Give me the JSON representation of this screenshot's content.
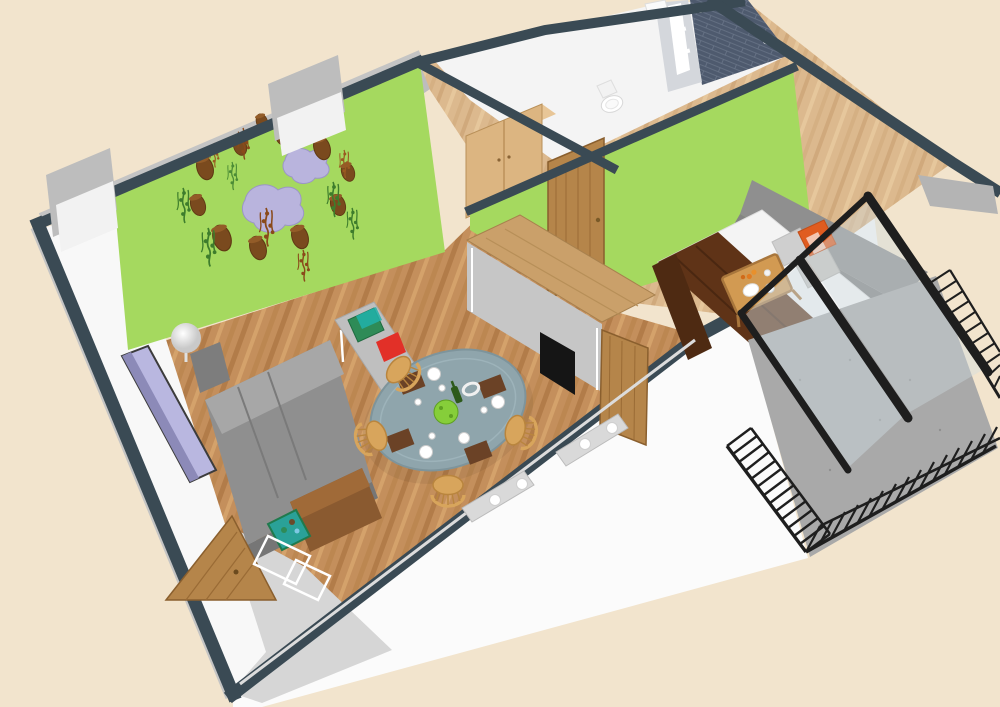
{
  "scene": {
    "kind": "3d-floor-plan-render",
    "view": "aerial-cutaway-perspective",
    "rooms": [
      {
        "name": "living-room",
        "floor": "wood",
        "feature": "green-mural-wall"
      },
      {
        "name": "hallway",
        "floor": "light-wood",
        "feature": "wardrobe"
      },
      {
        "name": "bathroom",
        "floor": "white",
        "feature": "dark-tile-shower"
      },
      {
        "name": "bedroom",
        "floor": "light-wood",
        "feature": "green-wall"
      },
      {
        "name": "balcony",
        "floor": "concrete",
        "feature": "metal-railing"
      }
    ],
    "furniture": [
      "grey-sofa",
      "wall-tv",
      "sphere-lamp",
      "lamp-cabinet",
      "wood-console",
      "toy-box",
      "grey-desk",
      "desk-items-red-green-remote",
      "round-dining-table",
      "wicker-chairs",
      "place-settings",
      "salad-bowl",
      "wine-bottle",
      "radiators",
      "entrance-door",
      "bar-counter",
      "open-door",
      "wardrobe",
      "bedroom-door",
      "toilet",
      "shower",
      "sink",
      "double-bed",
      "brown-blanket",
      "pillows",
      "breakfast-tray",
      "headboard-sofa",
      "bedside-table",
      "sliding-glass-doors",
      "balcony-railing"
    ]
  },
  "palette": {
    "background": "#f2e4cd",
    "wall_top": "#3a4a54",
    "wall_outer_grey": "#bdbdbd",
    "wall_white": "#fbfbfb",
    "left_wall_white": "#f8f8f8",
    "green_wall": "#a5d95f",
    "floor_wood": "#c48f5c",
    "floor_wood_stripe": "#b27c49",
    "floor_wood_light": "#dcb98e",
    "floor_wood_light_stripe": "#d0a97c",
    "bathroom_floor": "#f4f4f4",
    "entry_floor": "#d6d6d6",
    "balcony_floor": "#a9a9a9",
    "railing": "#1e1e1e",
    "glass": "#cfdbe2",
    "tile_dark": "#4e5a6e",
    "tile_line": "#6a7689",
    "fixture_white": "#ffffff",
    "door_wood": "#b5854a",
    "wardrobe_wood": "#dcb581",
    "counter_wood": "#caa06a",
    "counter_base": "#c6c6c6",
    "sofa_grey": "#8f8f8f",
    "sofa_grey_light": "#a7a7a7",
    "tv_lavender": "#b9b7e0",
    "table_top": "#8fa5ac",
    "wicker": "#d8a55c",
    "desk_grey": "#bfbfbf",
    "accent_red": "#e23028",
    "accent_teal": "#2aa198",
    "blanket_brown": "#5f3317",
    "mattress_white": "#f4f4f4",
    "pillow_orange": "#e05c20",
    "pot_brown": "#7a4a1e",
    "lavender_decor": "#b9b4dd",
    "vine_green": "#3e7d2c",
    "vine_rust": "#8a4a1a",
    "tray_wood": "#d29a52",
    "radiator_grey": "#d9d9d9"
  }
}
